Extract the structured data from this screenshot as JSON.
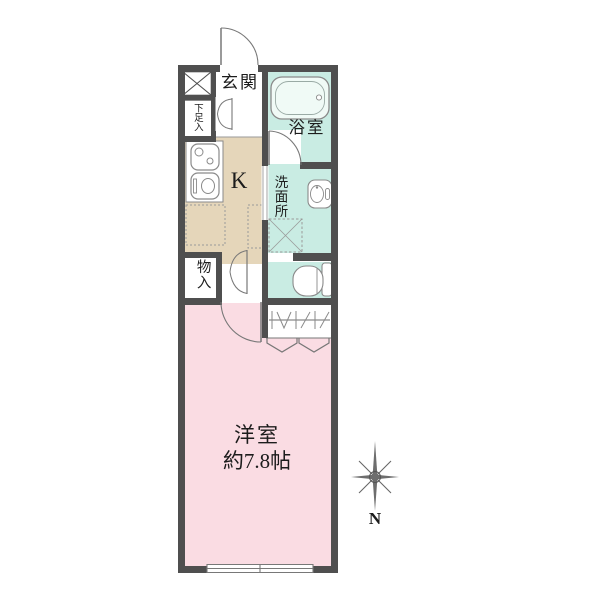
{
  "floorplan": {
    "rooms": {
      "entrance": {
        "label": "玄関"
      },
      "shoe_storage": {
        "label": "下足入"
      },
      "bathroom": {
        "label": "浴室"
      },
      "kitchen": {
        "label": "K"
      },
      "washroom": {
        "label": "洗面所"
      },
      "storage": {
        "label": "物入"
      },
      "western_room": {
        "label": "洋室",
        "size": "約7.8帖"
      }
    },
    "compass": {
      "north_label": "N"
    },
    "colors": {
      "wall": "#4f4f4f",
      "western_room": "#fadce3",
      "kitchen": "#e5d6ba",
      "wet_rooms": "#c9ece3",
      "fixture_line": "#888888",
      "background": "#ffffff"
    }
  }
}
